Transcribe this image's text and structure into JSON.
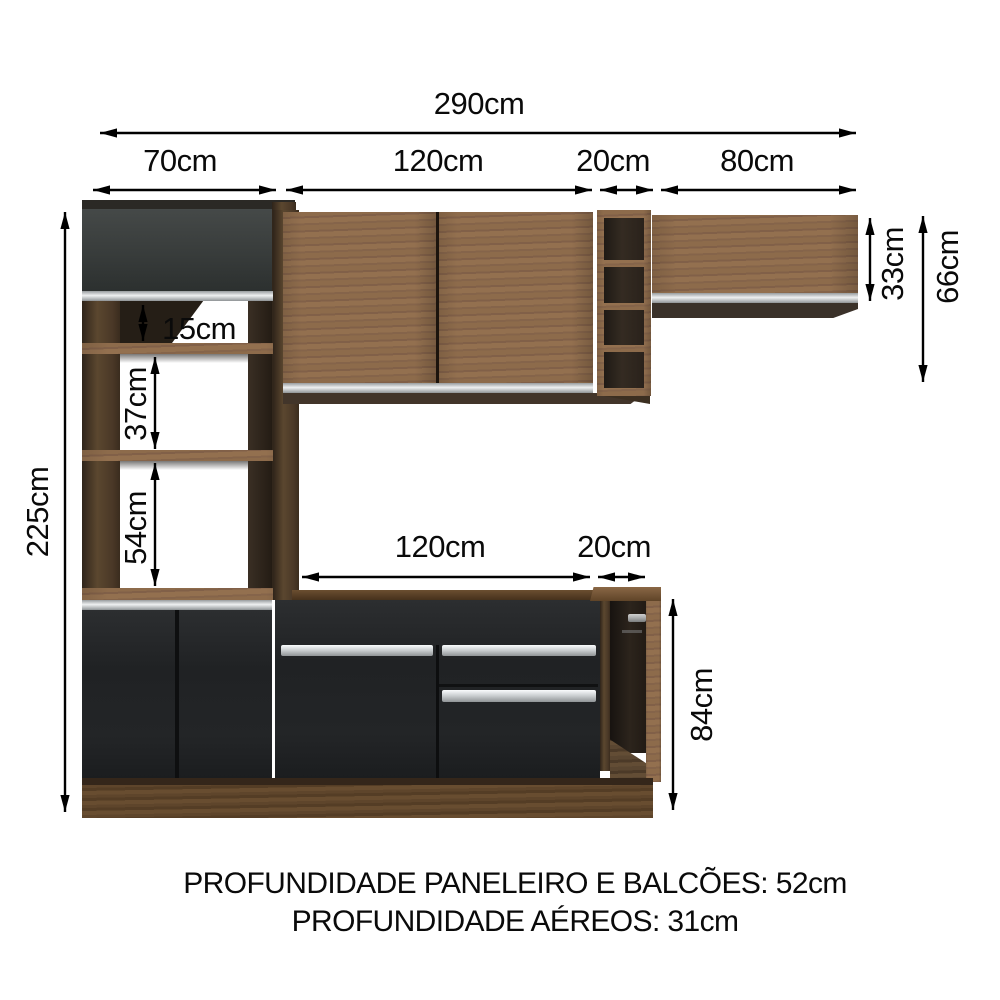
{
  "dims": {
    "total_width": "290cm",
    "pantry_width": "70cm",
    "upper_cabinet_width": "120cm",
    "upper_shelf_column_width": "20cm",
    "right_upper_cabinet_width": "80cm",
    "total_height": "225cm",
    "niche_top_height": "15cm",
    "niche_middle_height": "37cm",
    "niche_bottom_height": "54cm",
    "right_upper_cabinet_height": "33cm",
    "upper_section_height": "66cm",
    "counter_width": "120cm",
    "counter_end_width": "20cm",
    "counter_height": "84cm"
  },
  "footer": {
    "depth_pantry_counters": "PROFUNDIDADE PANELEIRO E BALCÕES: 52cm",
    "depth_wall_cabinets": "PROFUNDIDADE AÉREOS: 31cm"
  },
  "colors": {
    "wood_front": "#8a684a",
    "wood_dark": "#52402e",
    "wood_plinth": "#61462c",
    "black_front": "#242628",
    "grey_door": "#3a3e3d",
    "silver": "#d7dadc",
    "arrow": "#000000",
    "background": "#ffffff"
  }
}
